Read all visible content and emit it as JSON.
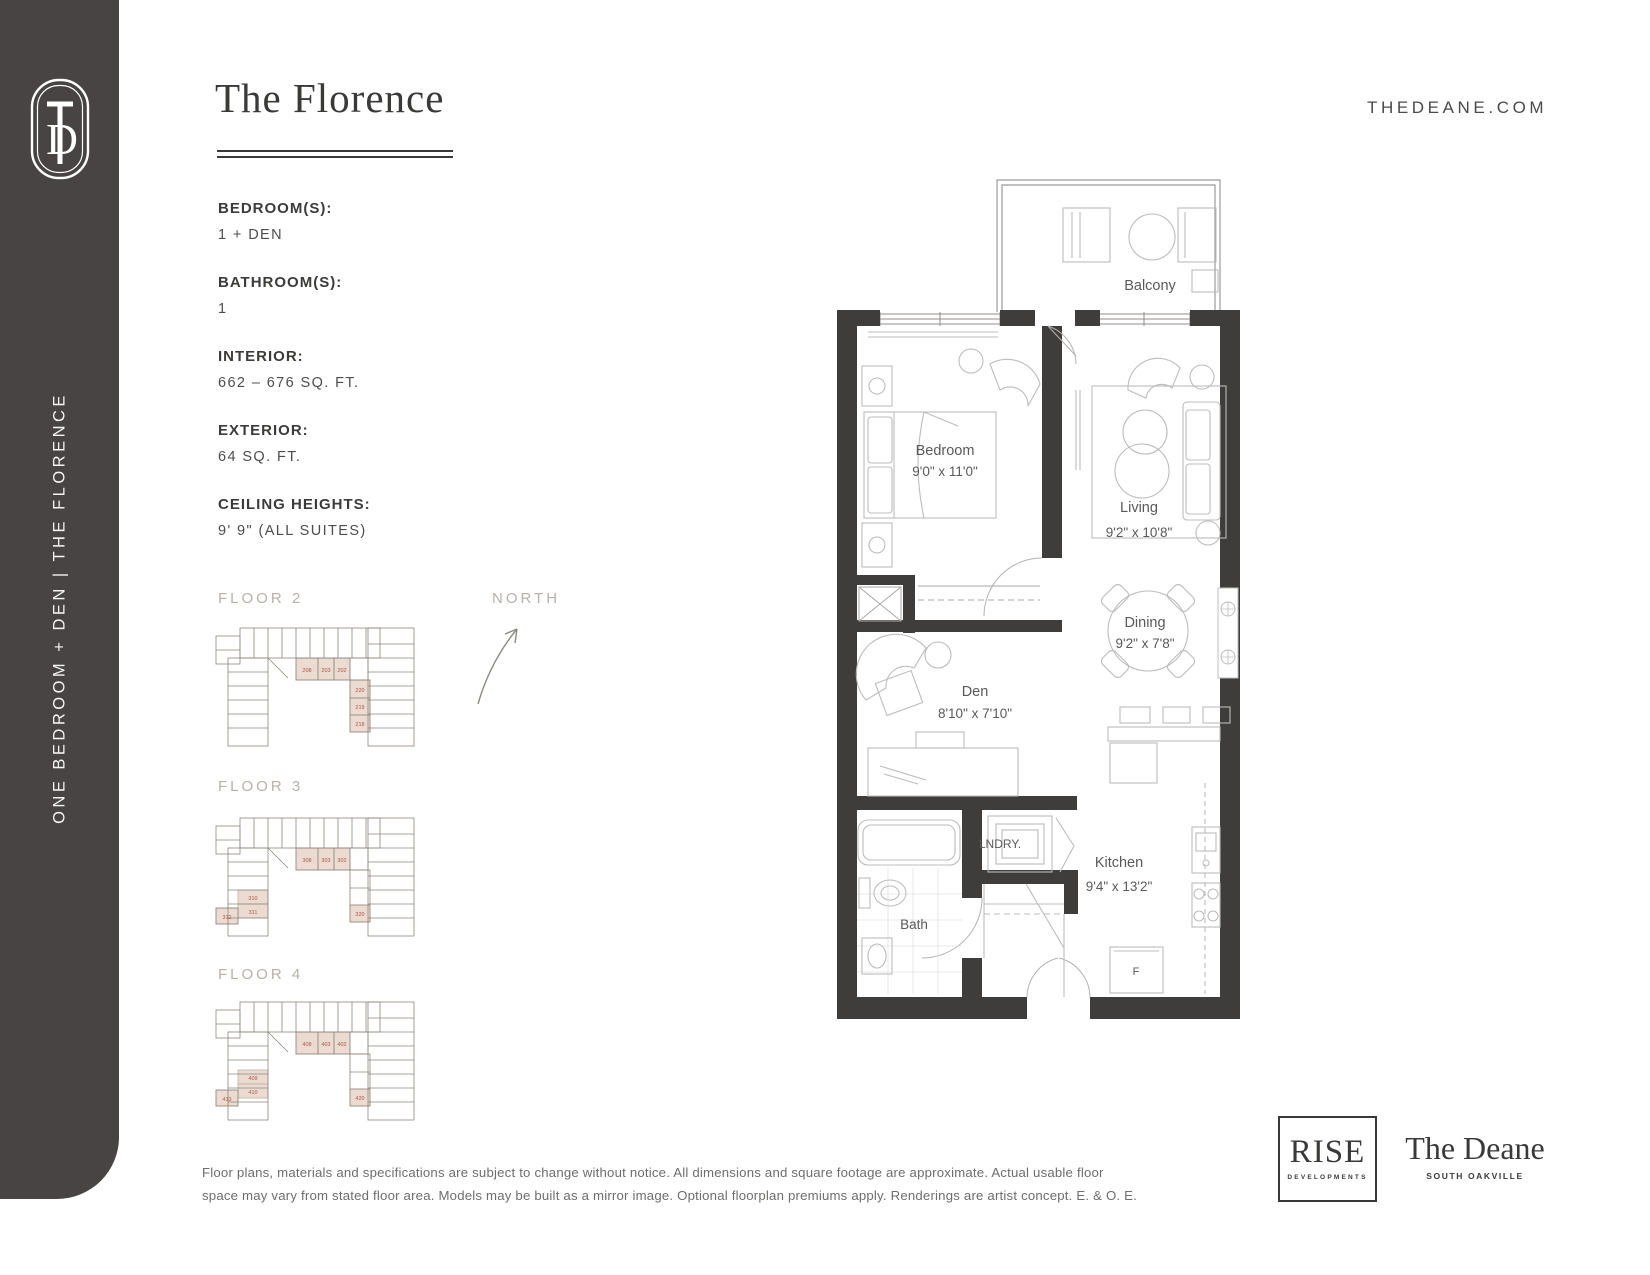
{
  "brand": {
    "monogram": "TD",
    "website": "THEDEANE.COM",
    "rise_name": "RISE",
    "rise_sub": "DEVELOPMENTS",
    "deane_name": "The Deane",
    "deane_sub": "SOUTH OAKVILLE"
  },
  "sidebar": {
    "vertical_text": "ONE BEDROOM + DEN  |  THE FLORENCE"
  },
  "header": {
    "title": "The Florence"
  },
  "specs": [
    {
      "label": "BEDROOM(S):",
      "value": "1 + DEN"
    },
    {
      "label": "BATHROOM(S):",
      "value": "1"
    },
    {
      "label": "INTERIOR:",
      "value": "662 – 676 SQ. FT."
    },
    {
      "label": "EXTERIOR:",
      "value": "64 SQ. FT."
    },
    {
      "label": "CEILING HEIGHTS:",
      "value": "9' 9\" (ALL SUITES)"
    }
  ],
  "north_label": "NORTH",
  "keyplans": [
    {
      "label": "FLOOR 2",
      "units": [
        "208",
        "203",
        "202",
        "220",
        "219",
        "218"
      ]
    },
    {
      "label": "FLOOR 3",
      "units": [
        "308",
        "303",
        "302",
        "310",
        "311",
        "312",
        "320"
      ]
    },
    {
      "label": "FLOOR 4",
      "units": [
        "408",
        "403",
        "402",
        "409",
        "410",
        "413",
        "420"
      ]
    }
  ],
  "floorplan": {
    "rooms": [
      {
        "name": "Balcony",
        "dims": ""
      },
      {
        "name": "Bedroom",
        "dims": "9'0\" x 11'0\""
      },
      {
        "name": "Living",
        "dims": "9'2\" x 10'8\""
      },
      {
        "name": "Dining",
        "dims": "9'2\" x 7'8\""
      },
      {
        "name": "Den",
        "dims": "8'10\" x 7'10\""
      },
      {
        "name": "Kitchen",
        "dims": "9'4\" x 13'2\""
      },
      {
        "name": "Bath",
        "dims": ""
      },
      {
        "name": "LNDRY.",
        "dims": ""
      }
    ],
    "fridge_label": "F"
  },
  "disclaimer": {
    "line1": "Floor plans, materials and specifications are subject to change without notice. All dimensions and square footage are approximate. Actual usable floor",
    "line2": "space may vary from stated floor area. Models may be built as a mirror image. Optional floorplan premiums apply. Renderings are artist concept. E. & O. E."
  },
  "colors": {
    "sidebar": "#474443",
    "wall": "#3e3d3c",
    "highlight": "#ecdbd0",
    "unit_text": "#a8574c"
  }
}
